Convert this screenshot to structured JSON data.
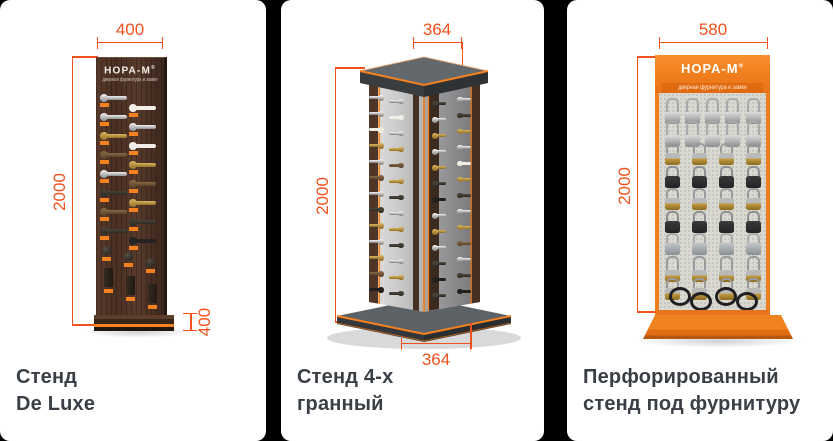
{
  "page": {
    "background": "#000000",
    "card_background": "#FFFFFF"
  },
  "colors": {
    "dimension_orange": "#F1511C",
    "brand_orange": "#F5821F",
    "caption_gray": "#3A3F46"
  },
  "cards": [
    {
      "caption": [
        "Стенд",
        "De Luxe"
      ],
      "dimensions": {
        "width_top": "400",
        "height_left": "2000",
        "depth_bottom": "400"
      },
      "stand": {
        "logo": "НОРА-М",
        "logo_reg": "®",
        "logo_subtitle": "дверная фурнитура и замки",
        "lever_rows": [
          [
            "chrome",
            "white"
          ],
          [
            "chrome",
            "chrome"
          ],
          [
            "gold",
            "white"
          ],
          [
            "bronze",
            "gold"
          ],
          [
            "chrome",
            "bronze"
          ],
          [
            "dark",
            "gold"
          ],
          [
            "bronze",
            "dark"
          ],
          [
            "dark",
            "black"
          ]
        ],
        "knob_finishes": [
          "black",
          "black",
          "black"
        ],
        "hinge_count": 3
      }
    },
    {
      "caption": [
        "Стенд 4-х",
        "гранный"
      ],
      "dimensions": {
        "width_top": "364",
        "height_left": "2000",
        "width_bottom": "364"
      },
      "stand": {
        "columns": [
          [
            "chrome",
            "chrome",
            "white",
            "gold",
            "chrome",
            "bronze",
            "chrome",
            "dark",
            "gold",
            "chrome",
            "gold",
            "bronze",
            "black"
          ],
          [
            "chrome",
            "white",
            "chrome",
            "gold",
            "bronze",
            "gold",
            "dark",
            "chrome",
            "gold",
            "dark",
            "chrome",
            "gold",
            "dark"
          ],
          [
            "dark",
            "chrome",
            "gold",
            "chrome",
            "gold",
            "dark",
            "black",
            "chrome",
            "gold",
            "chrome",
            "dark",
            "black",
            "dark"
          ],
          [
            "chrome",
            "dark",
            "gold",
            "chrome",
            "white",
            "gold",
            "dark",
            "chrome",
            "gold",
            "bronze",
            "chrome",
            "dark",
            "black"
          ]
        ]
      }
    },
    {
      "caption": [
        "Перфорированный",
        "стенд под фурнитуру"
      ],
      "dimensions": {
        "width_top": "580",
        "height_left": "2000"
      },
      "stand": {
        "logo": "НОРА-М",
        "logo_reg": "®",
        "logo_subtitle": "дверная фурнитура и замки",
        "padlock_rows": [
          {
            "finish": "silver",
            "count": 5,
            "tall": true
          },
          {
            "finish": "silver",
            "count": 5,
            "tall": true
          },
          {
            "finish": "brass",
            "count": 4,
            "tall": false
          },
          {
            "finish": "black",
            "count": 4,
            "tall": false
          },
          {
            "finish": "brass",
            "count": 4,
            "tall": false
          },
          {
            "finish": "black",
            "count": 4,
            "tall": false
          },
          {
            "finish": "steel",
            "count": 4,
            "tall": false
          },
          {
            "finish": "brass",
            "count": 4,
            "tall": true
          },
          {
            "finish": "brass",
            "count": 4,
            "tall": false
          }
        ],
        "cable_lock_count": 4
      }
    }
  ]
}
